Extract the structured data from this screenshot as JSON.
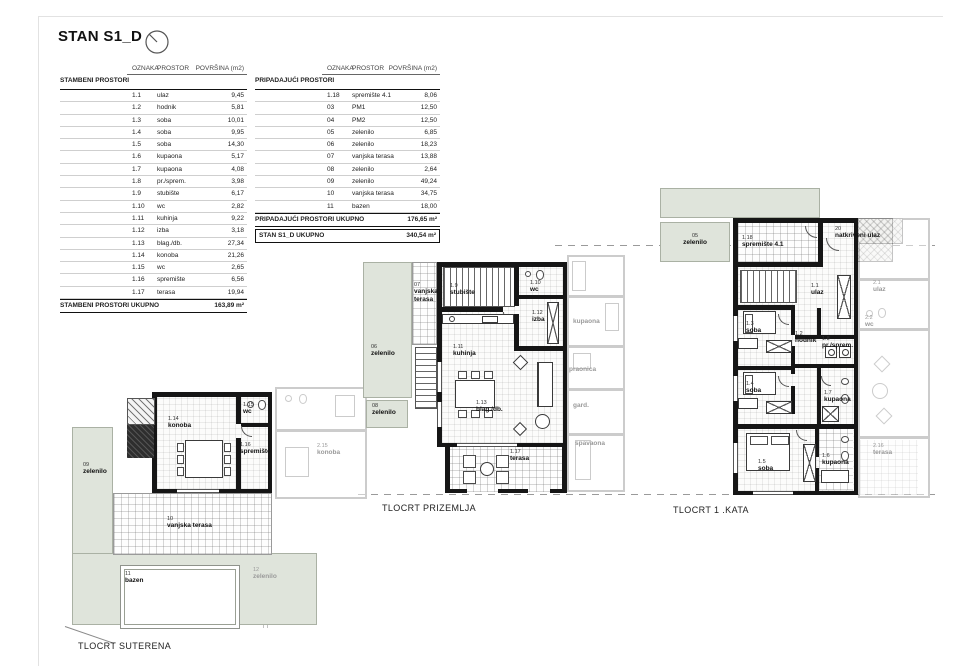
{
  "title": "STAN S1_D",
  "tables": {
    "columns": [
      "OZNAKA",
      "PROSTOR",
      "POVRŠINA (m2)"
    ],
    "left": {
      "section": "STAMBENI PROSTORI",
      "rows": [
        [
          "1.1",
          "ulaz",
          "9,45"
        ],
        [
          "1.2",
          "hodnik",
          "5,81"
        ],
        [
          "1.3",
          "soba",
          "10,01"
        ],
        [
          "1.4",
          "soba",
          "9,95"
        ],
        [
          "1.5",
          "soba",
          "14,30"
        ],
        [
          "1.6",
          "kupaona",
          "5,17"
        ],
        [
          "1.7",
          "kupaona",
          "4,08"
        ],
        [
          "1.8",
          "pr./sprem.",
          "3,98"
        ],
        [
          "1.9",
          "stubište",
          "6,17"
        ],
        [
          "1.10",
          "wc",
          "2,82"
        ],
        [
          "1.11",
          "kuhinja",
          "9,22"
        ],
        [
          "1.12",
          "izba",
          "3,18"
        ],
        [
          "1.13",
          "blag./db.",
          "27,34"
        ],
        [
          "1.14",
          "konoba",
          "21,26"
        ],
        [
          "1.15",
          "wc",
          "2,65"
        ],
        [
          "1.16",
          "spremište",
          "6,56"
        ],
        [
          "1.17",
          "terasa",
          "19,94"
        ]
      ],
      "total_label": "STAMBENI PROSTORI UKUPNO",
      "total_value": "163,89 m²"
    },
    "right": {
      "section": "PRIPADAJUĆI PROSTORI",
      "rows": [
        [
          "1.18",
          "spremište 4.1",
          "8,06"
        ],
        [
          "03",
          "PM1",
          "12,50"
        ],
        [
          "04",
          "PM2",
          "12,50"
        ],
        [
          "05",
          "zelenilo",
          "6,85"
        ],
        [
          "06",
          "zelenilo",
          "18,23"
        ],
        [
          "07",
          "vanjska terasa",
          "13,88"
        ],
        [
          "08",
          "zelenilo",
          "2,64"
        ],
        [
          "09",
          "zelenilo",
          "49,24"
        ],
        [
          "10",
          "vanjska terasa",
          "34,75"
        ],
        [
          "11",
          "bazen",
          "18,00"
        ]
      ],
      "total_label": "PRIPADAJUĆI PROSTORI UKUPNO",
      "total_value": "176,65 m²",
      "grand_label": "STAN S1_D UKUPNO",
      "grand_value": "340,54 m²"
    }
  },
  "plans": {
    "suterena": {
      "caption": "TLOCRT SUTERENA",
      "rooms": {
        "konoba": {
          "code": "1.14",
          "name": "konoba"
        },
        "wc": {
          "code": "1.15",
          "name": "wc"
        },
        "spremiste": {
          "code": "1.16",
          "name": "spremište"
        },
        "zelenilo09": {
          "code": "09",
          "name": "zelenilo"
        },
        "terasa10": {
          "code": "10",
          "name": "vanjska terasa"
        },
        "bazen": {
          "code": "11",
          "name": "bazen"
        },
        "zelenilo12": {
          "code": "12",
          "name": "zelenilo"
        },
        "nb_konoba": {
          "code": "2.15",
          "name": "konoba"
        }
      }
    },
    "prizemlje": {
      "caption": "TLOCRT PRIZEMLJA",
      "rooms": {
        "stubiste": {
          "code": "1.9",
          "name": "stubište"
        },
        "wc": {
          "code": "1.10",
          "name": "wc"
        },
        "kuhinja": {
          "code": "1.11",
          "name": "kuhinja"
        },
        "izba": {
          "code": "1.12",
          "name": "izba"
        },
        "blag": {
          "code": "1.13",
          "name": "blag./db."
        },
        "terasa": {
          "code": "1.17",
          "name": "terasa"
        },
        "vterasa07": {
          "code": "07",
          "name": "vanjska terasa"
        },
        "zelenilo06": {
          "code": "06",
          "name": "zelenilo"
        },
        "zelenilo08": {
          "code": "08",
          "name": "zelenilo"
        }
      },
      "neighbor": {
        "kupaona": "kupaona",
        "praonica": "praonica",
        "gard": "gard.",
        "spavaona": "spavaona"
      }
    },
    "kata": {
      "caption": "TLOCRT 1 .KATA",
      "rooms": {
        "zelenilo05": {
          "code": "05",
          "name": "zelenilo"
        },
        "spremiste41": {
          "code": "1.18",
          "name": "spremište 4.1"
        },
        "natkriveni": {
          "code": "20",
          "name": "natkriveni ulaz"
        },
        "ulaz": {
          "code": "1.1",
          "name": "ulaz"
        },
        "soba13": {
          "code": "1.3",
          "name": "soba"
        },
        "hodnik": {
          "code": "1.2",
          "name": "hodnik"
        },
        "prsprem": {
          "code": "1.8",
          "name": "pr./sprem."
        },
        "soba14": {
          "code": "1.4",
          "name": "soba"
        },
        "kupaona17": {
          "code": "1.7",
          "name": "kupaona"
        },
        "soba15": {
          "code": "1.5",
          "name": "soba"
        },
        "kupaona16": {
          "code": "1.6",
          "name": "kupaona"
        }
      },
      "neighbor": {
        "ulaz21": {
          "code": "2.1",
          "name": "ulaz"
        },
        "wc22": {
          "code": "2.2",
          "name": "wc"
        },
        "terasa216": {
          "code": "2.16",
          "name": "terasa"
        }
      }
    }
  }
}
